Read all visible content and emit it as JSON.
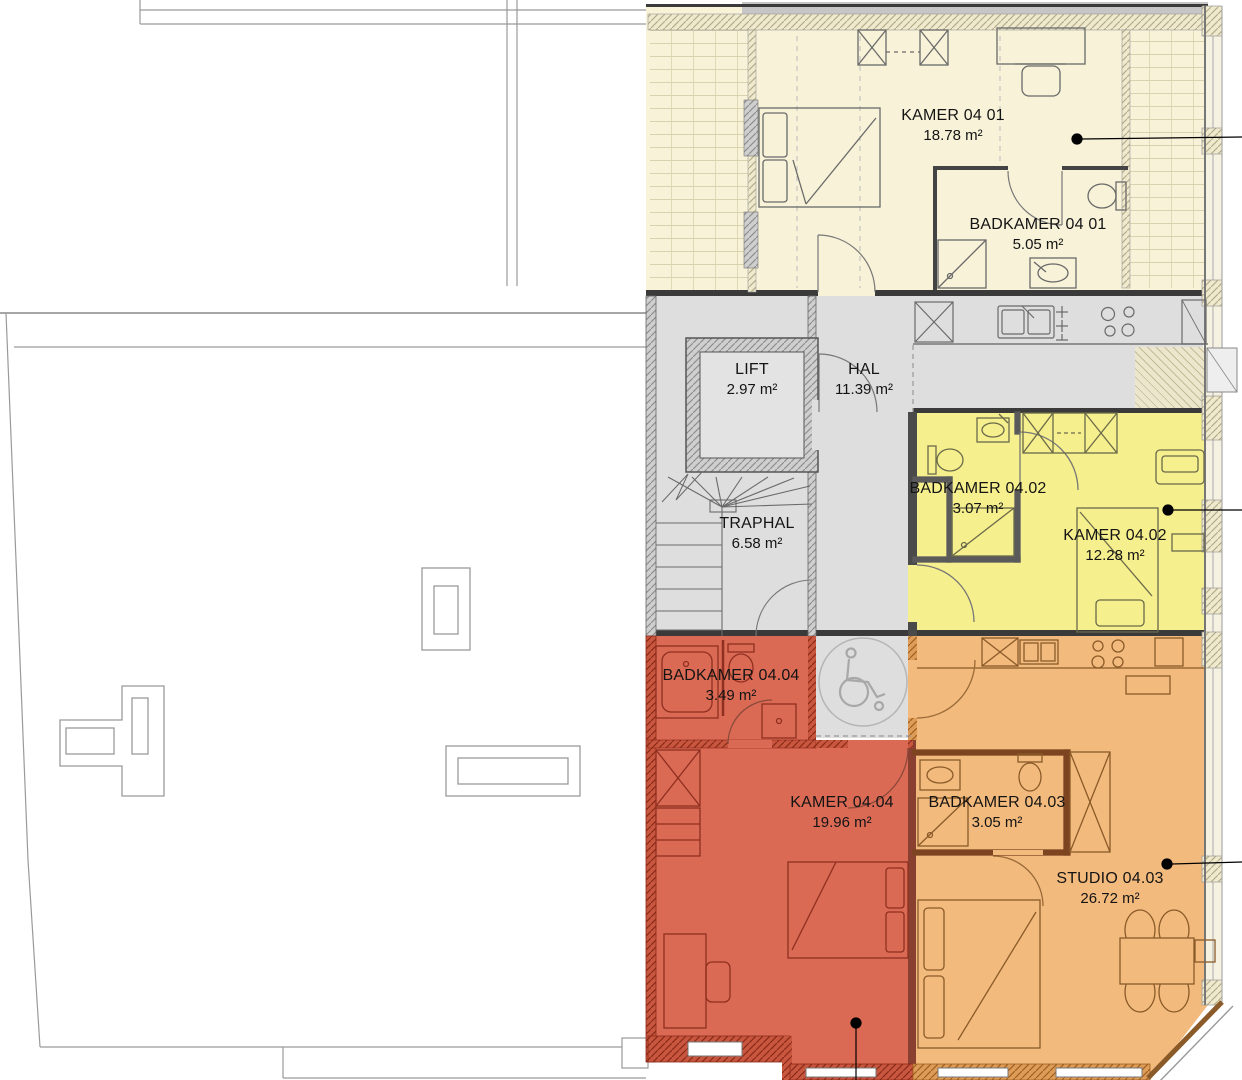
{
  "plan_title": "Floor plan level 04",
  "rooms": {
    "kamer0401": {
      "name": "KAMER 04 01",
      "area": "18.78 m²"
    },
    "badkamer0401": {
      "name": "BADKAMER 04 01",
      "area": "5.05 m²"
    },
    "lift": {
      "name": "LIFT",
      "area": "2.97 m²"
    },
    "hal": {
      "name": "HAL",
      "area": "11.39 m²"
    },
    "traphal": {
      "name": "TRAPHAL",
      "area": "6.58 m²"
    },
    "badkamer0402": {
      "name": "BADKAMER 04.02",
      "area": "3.07 m²"
    },
    "kamer0402": {
      "name": "KAMER 04.02",
      "area": "12.28 m²"
    },
    "badkamer0404": {
      "name": "BADKAMER 04.04",
      "area": "3.49 m²"
    },
    "kamer0404": {
      "name": "KAMER 04.04",
      "area": "19.96 m²"
    },
    "badkamer0403": {
      "name": "BADKAMER 04.03",
      "area": "3.05 m²"
    },
    "studio0403": {
      "name": "STUDIO 04.03",
      "area": "26.72 m²"
    }
  },
  "colors": {
    "cream": "#f7f2d8",
    "common_gray": "#dedede",
    "unit_0402_yellow": "#f6ef8d",
    "unit_0404_red": "#db6a55",
    "unit_0403_orange": "#f3ba7d",
    "top_band_gray": "#c6c6c6",
    "shaft_cream": "#ece6cc",
    "wall_dark": "#3a3a3a",
    "marker_black": "#000000",
    "wheelchair_gray": "#a8a8a8"
  },
  "icons": {
    "wheelchair": "wheelchair-turning-circle"
  }
}
